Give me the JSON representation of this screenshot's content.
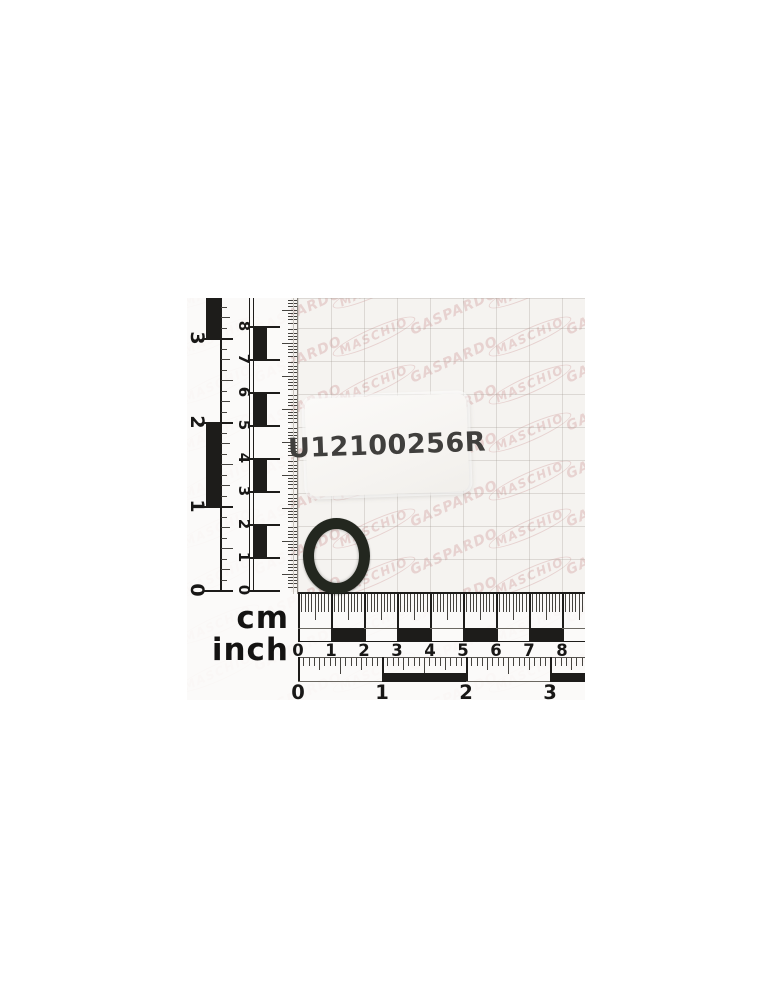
{
  "photo": {
    "label": {
      "part_number": "U12100256R"
    },
    "watermark": {
      "brand_a": "MASCHIO",
      "brand_b": "GASPARDO",
      "color": "#e7d2d0"
    },
    "ruler": {
      "cm_unit_label": "cm",
      "inch_unit_label": "inch",
      "h_cm_numbers": [
        "0",
        "1",
        "2",
        "3",
        "4",
        "5",
        "6",
        "7",
        "8"
      ],
      "h_inch_numbers": [
        "0",
        "1",
        "2",
        "3"
      ],
      "v_cm_numbers": [
        "0",
        "1",
        "2",
        "3",
        "4",
        "5",
        "6",
        "7",
        "8"
      ],
      "v_inch_numbers": [
        "0",
        "1",
        "2",
        "3"
      ]
    },
    "colors": {
      "paper": "#f5f3f0",
      "ruler_ink": "#1d1c1a",
      "grid_line": "#a29a92",
      "oring": "#23271f",
      "sticker_text": "#403f3d"
    }
  }
}
